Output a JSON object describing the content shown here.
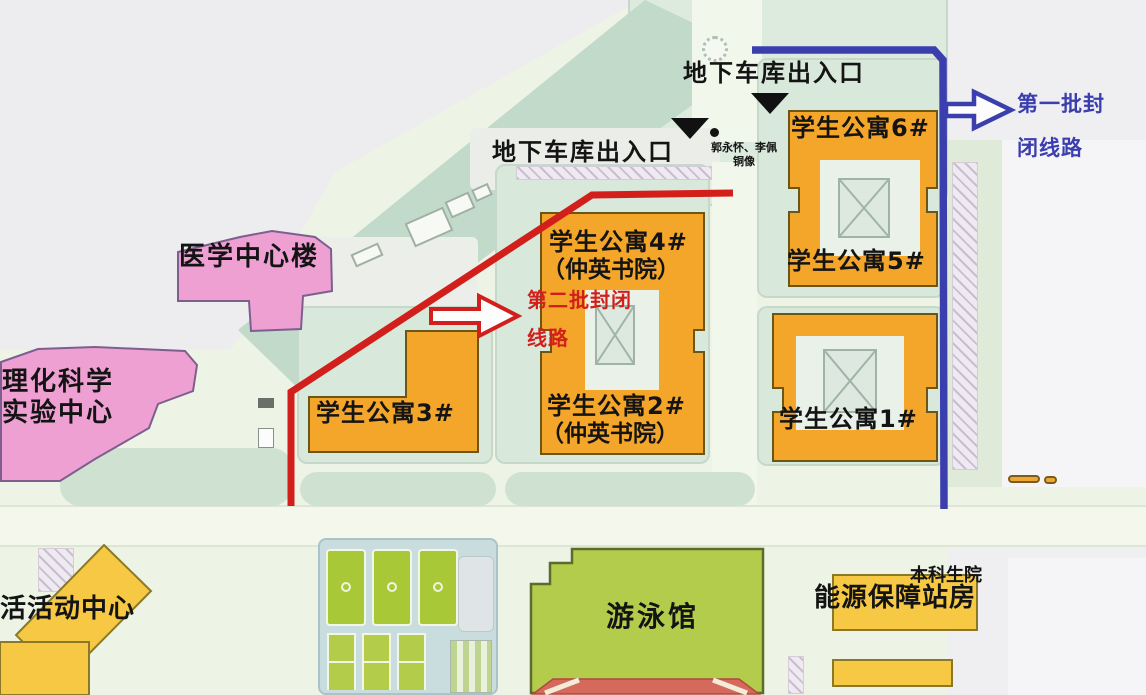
{
  "map_labels": {
    "garage_exit_top": "地下车库出入口",
    "garage_exit_west": "地下车库出入口",
    "statues_line1": "郭永怀、李佩",
    "statues_line2": "铜像"
  },
  "routes": {
    "first_batch": {
      "line1": "第一批封",
      "line2": "闭线路",
      "color": "#3B3FAE"
    },
    "second_batch": {
      "line1": "第二批封闭",
      "line2": "线路",
      "color": "#D1201C"
    }
  },
  "buildings": {
    "apartment6": {
      "label": "学生公寓6#"
    },
    "apartment5": {
      "label": "学生公寓5#"
    },
    "apartment4": {
      "line1": "学生公寓4#",
      "line2": "（仲英书院）"
    },
    "apartment2": {
      "line1": "学生公寓2#",
      "line2": "（仲英书院）"
    },
    "apartment3": {
      "label": "学生公寓3#"
    },
    "apartment1": {
      "label": "学生公寓1#"
    },
    "medical_center": {
      "label": "医学中心楼"
    },
    "science_experiment_center": {
      "line1": "理化科学",
      "line2": "实验中心"
    },
    "activity_center": {
      "label": "活活动中心"
    },
    "swimming_pool": {
      "label": "游泳馆"
    },
    "energy_station": {
      "label": "能源保障站房"
    },
    "undergraduate_school": {
      "label": "本科生院"
    }
  },
  "palette": {
    "apartment_fill": "#F4A62A",
    "pink_building_fill": "#EFA0D2",
    "yellow_building_fill": "#F6C844",
    "pool_building_fill": "#B4CC4C",
    "court_fill": "#A9C838",
    "entrance_roof_red": "#D5695B",
    "route_first_blue": "#3B3FAE",
    "route_second_red": "#D1201C"
  }
}
